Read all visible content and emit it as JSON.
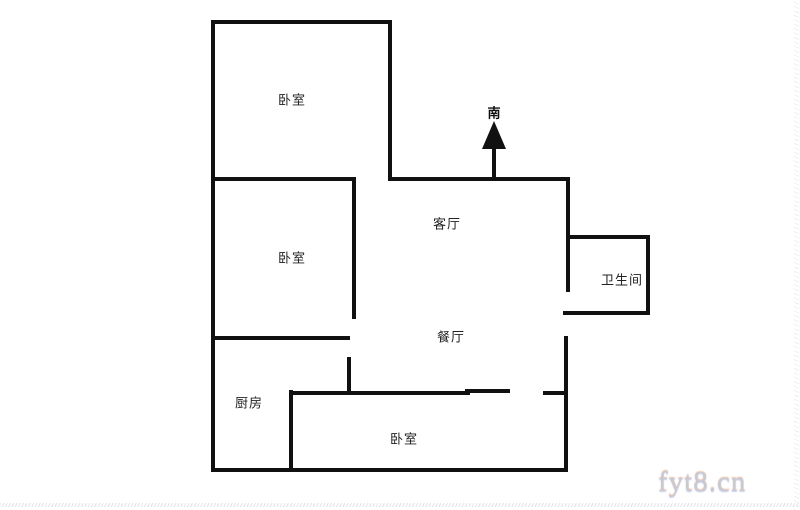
{
  "floorplan": {
    "compass": {
      "label": "南",
      "direction": "up"
    },
    "rooms": [
      {
        "name": "bedroom-top",
        "label": "卧室"
      },
      {
        "name": "bedroom-middle",
        "label": "卧室"
      },
      {
        "name": "living-room",
        "label": "客厅"
      },
      {
        "name": "dining-room",
        "label": "餐厅"
      },
      {
        "name": "bathroom",
        "label": "卫生间"
      },
      {
        "name": "kitchen",
        "label": "厨房"
      },
      {
        "name": "bedroom-bottom",
        "label": "卧室"
      }
    ],
    "colors": {
      "wall": "#111111",
      "background": "#ffffff",
      "label_text": "#222222",
      "watermark": "#c7cad0"
    }
  },
  "watermark": {
    "text": "fyt8.cn"
  }
}
